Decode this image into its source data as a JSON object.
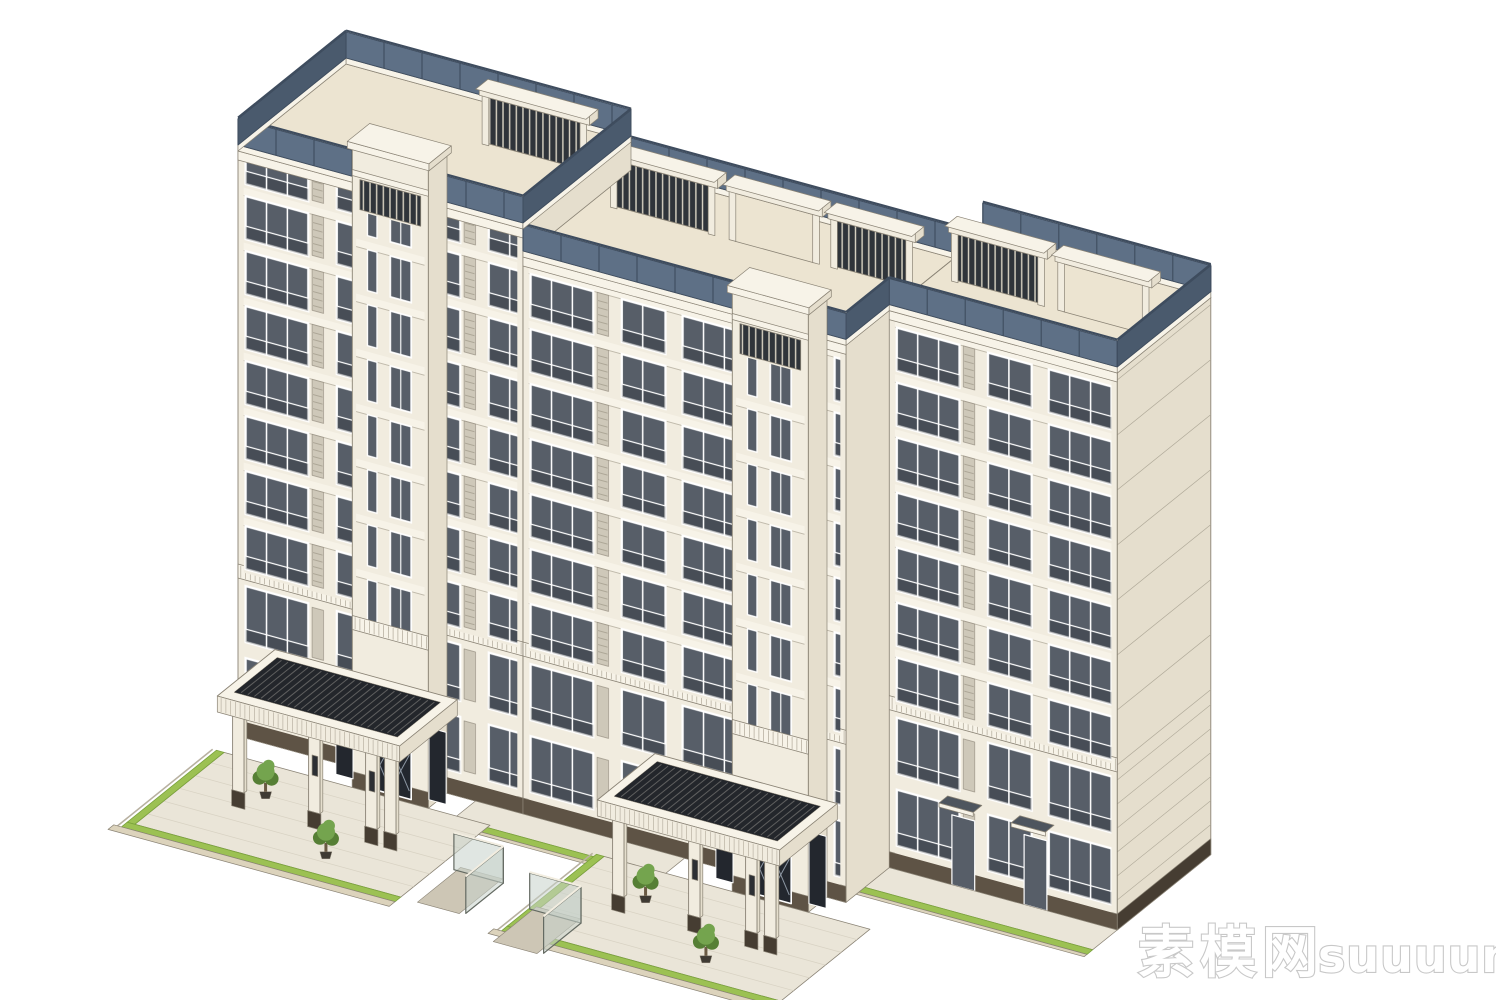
{
  "meta": {
    "background": "#FFFFFF",
    "render_type": "3D architectural massing model render (SketchUp-style, isometric view)",
    "subject": "Multi-storey cream residential apartment building with stepped blocks, dark window glazing, rooftop pergola lattices, glass roof parapets and two entrance porticos with landscaping"
  },
  "watermark": {
    "cn": "素模网",
    "latin": "suuuum.com"
  },
  "palette": {
    "wall": "#F1ECDF",
    "wall_shade": "#E5DECD",
    "wall_light": "#F7F3E8",
    "deck": "#ECE4D1",
    "parapet_glass": "#5E7086",
    "parapet_glass_dark": "#4A5A6D",
    "parapet_frame": "#3E4C5E",
    "glass": "#575E68",
    "louver": "#CEC8B9",
    "lattice": "#2F343A",
    "canopy": "#23262B",
    "canopy_top": "#4E555E",
    "door": "#23272E",
    "plinth": "#5E5345",
    "plinth_dark": "#463D32",
    "grass": "#9CC153",
    "grass_dark": "#7AA23C",
    "plaza": "#EAE5D8",
    "tree": "#74A44E",
    "tree_dark": "#567F35",
    "glassbox": "rgba(198,210,202,0.55)",
    "glassbox_frame": "#646A62",
    "edge": "#8A8375",
    "edge2": "#AFA898",
    "curb": "#DCD3BC"
  }
}
